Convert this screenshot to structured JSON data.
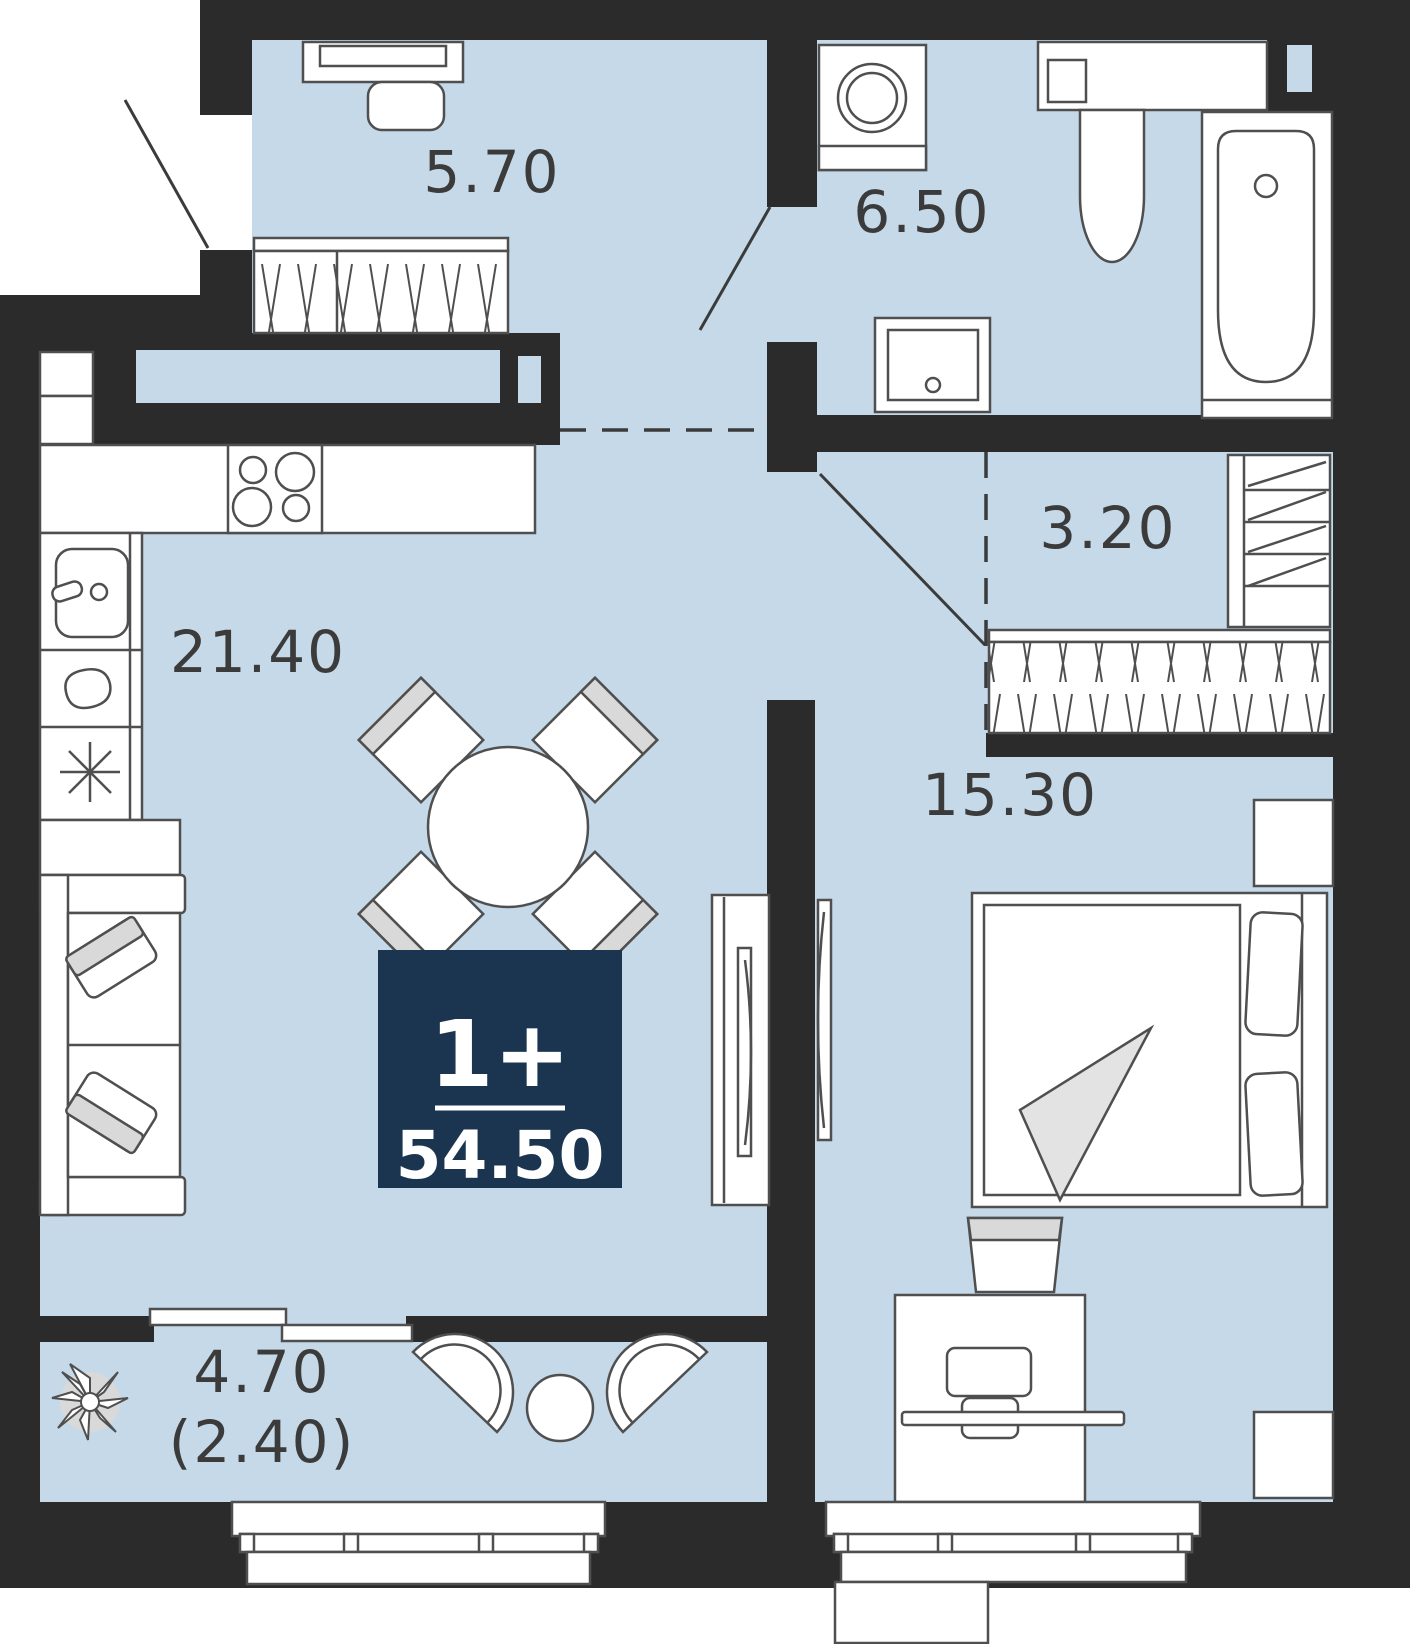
{
  "title": "Apartment floor plan",
  "badge": {
    "rooms_label": "1+",
    "total_area": "54.50"
  },
  "rooms": [
    {
      "id": "hallway",
      "area": "5.70"
    },
    {
      "id": "bathroom",
      "area": "6.50"
    },
    {
      "id": "closet",
      "area": "3.20"
    },
    {
      "id": "kitchen-living",
      "area": "21.40"
    },
    {
      "id": "bedroom",
      "area": "15.30"
    },
    {
      "id": "balcony",
      "area": "4.70"
    },
    {
      "id": "balcony-coefficient",
      "area": "(2.40)"
    }
  ],
  "colors": {
    "floor": "#c5d9e8",
    "wall": "#2b2b2b",
    "badge_bg": "#1b3551",
    "furniture_stroke": "#4f4f4f",
    "label_text": "#3b3b3b",
    "cushion_gray": "#d9d9d9"
  }
}
